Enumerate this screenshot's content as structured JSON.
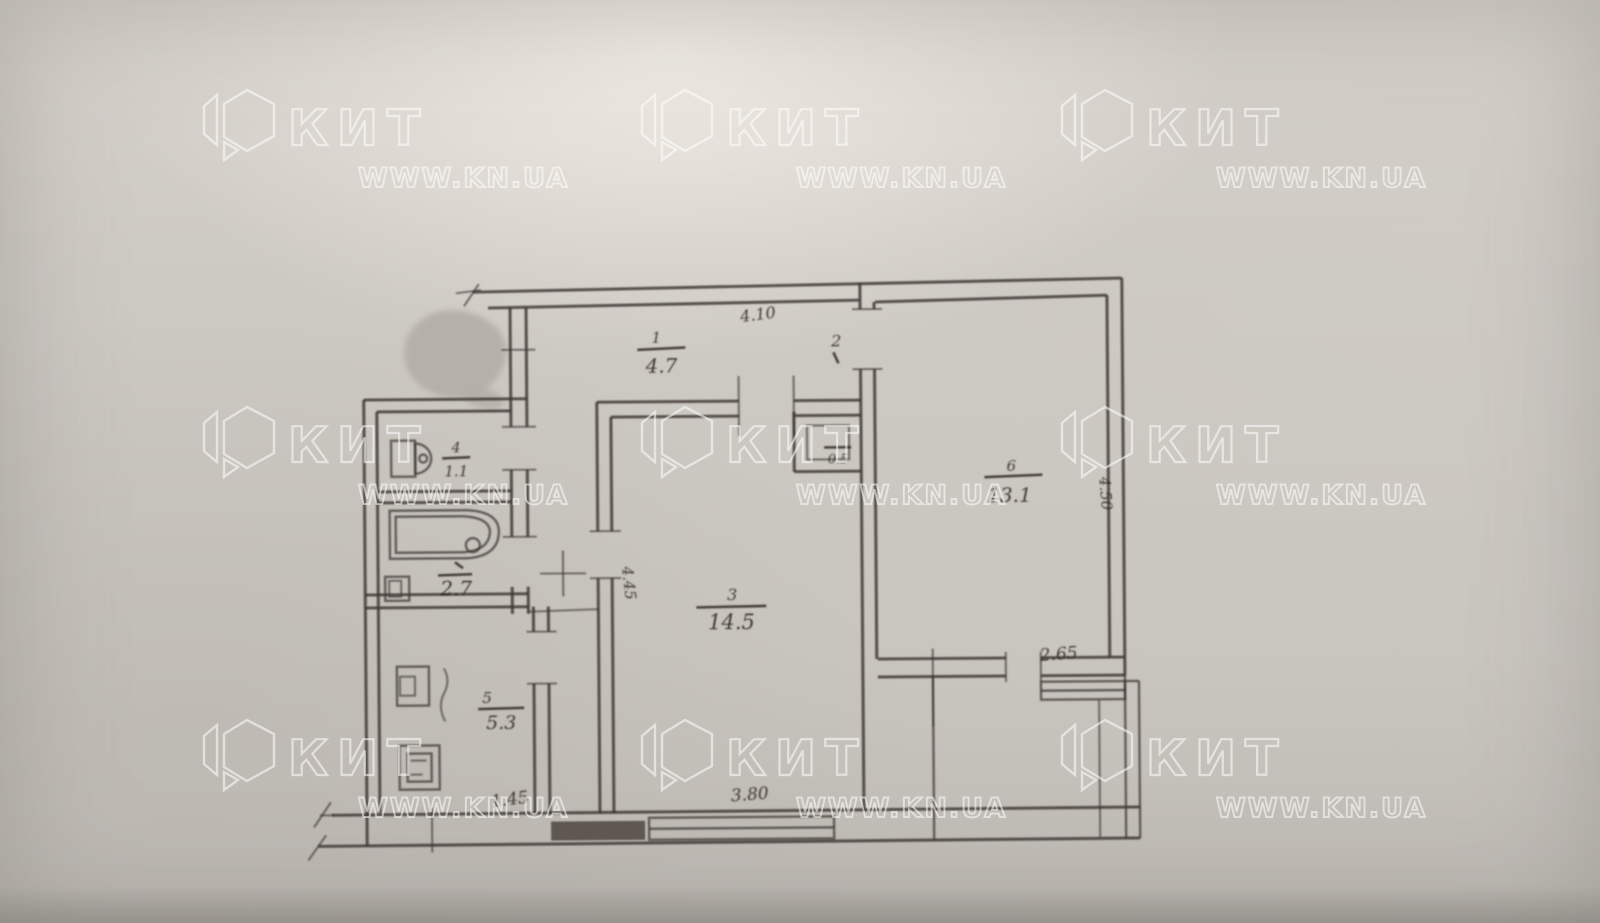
{
  "watermark": {
    "brand": "КИТ",
    "site": "WWW.KN.UA"
  },
  "plan": {
    "type": "apartment-floor-plan",
    "rooms": {
      "hall": {
        "number": "1",
        "area": "4.7"
      },
      "closet": {
        "number": "2",
        "area": "0.5"
      },
      "living": {
        "number": "3",
        "area": "14.5"
      },
      "wc": {
        "number": "4",
        "area": "1.1"
      },
      "bath": {
        "area": "2.7"
      },
      "kitchen": {
        "number": "5",
        "area": "5.3"
      },
      "bedroom": {
        "number": "6",
        "area": "13.1"
      }
    },
    "dimensions": {
      "hall_top": "4.10",
      "bedroom_side": "4.50",
      "living_side": "4.45",
      "bedroom_window": "2.65",
      "living_window": "3.80",
      "kitchen_bottom": "1.45"
    }
  },
  "colors": {
    "paper": "#cdc9c3",
    "ink": "#3b3630",
    "watermark": "#ffffff",
    "smudge": "#b3afa8"
  }
}
